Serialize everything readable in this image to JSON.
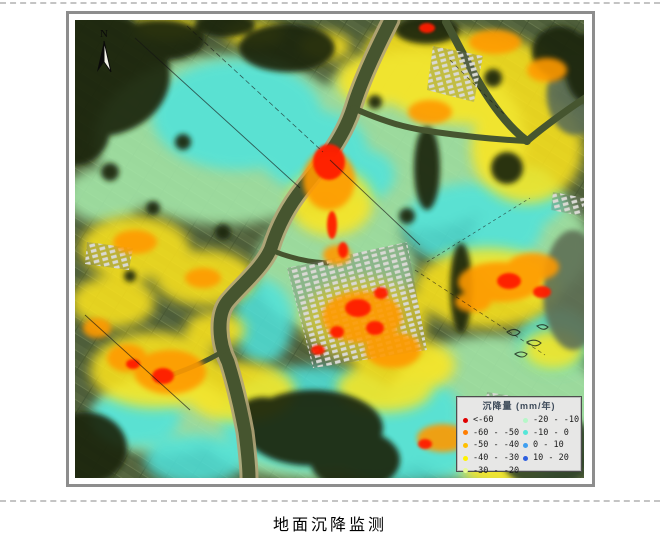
{
  "figure": {
    "caption": "地面沉降监测"
  },
  "map": {
    "north_label": "N",
    "legend": {
      "title": "沉降量 (mm/年)",
      "items": [
        {
          "label": "<-60",
          "color": "#e00000"
        },
        {
          "label": "-60 - -50",
          "color": "#ff7d00"
        },
        {
          "label": "-50 - -40",
          "color": "#ffc000"
        },
        {
          "label": "-40 - -30",
          "color": "#fff200"
        },
        {
          "label": "-30 - -20",
          "color": "#e8fa96"
        },
        {
          "label": "-20 - -10",
          "color": "#b6f7c8"
        },
        {
          "label": "-10 - 0",
          "color": "#55e6d8"
        },
        {
          "label": "0 - 10",
          "color": "#3f9ff0"
        },
        {
          "label": "10 - 20",
          "color": "#2d5fe0"
        }
      ],
      "left_column_rows": 5
    },
    "palette": {
      "severe_subsidence": "#ff1e00",
      "high_subsidence": "#ff9a00",
      "moderate_subsidence": "#ffe61e",
      "slight_subsidence": "#a9efae",
      "stable_uplift": "#4fe3dc",
      "river_water": "#46552f",
      "vegetation_dark": "#1b270f"
    }
  }
}
